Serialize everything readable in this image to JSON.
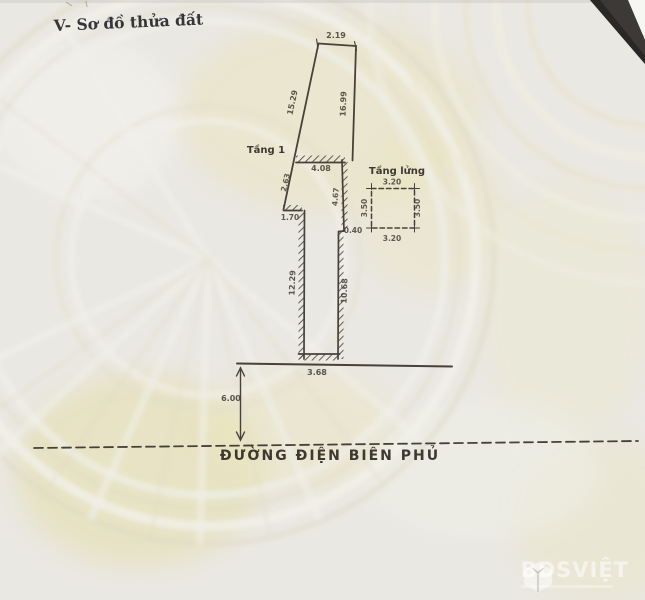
{
  "title": "V- Sơ đồ thửa đất",
  "plot": {
    "floor1_label": "Tầng 1",
    "mezzanine_label": "Tầng lửng",
    "street_name": "ĐƯỜNG ĐIỆN BIÊN PHỦ",
    "dims": {
      "top_width": "2.19",
      "left_side": "15.29",
      "right_side": "16.99",
      "f1_top": "4.08",
      "f1_left_slant": "2.63",
      "f1_notch": "1.70",
      "f1_right_upper": "4.67",
      "f1_step": "0.40",
      "f1_left": "12.29",
      "f1_right_lower": "10.68",
      "f1_bottom": "3.68",
      "mezz_top": "3.20",
      "mezz_bottom": "3.20",
      "mezz_left": "3.50",
      "mezz_right": "3.50",
      "road_setback": "6.00"
    }
  },
  "watermark": {
    "brand": "BDSVIỆT"
  },
  "colors": {
    "ink": "#47413a",
    "paper": "#eae8e2",
    "seal_yellow": "#e8e2ba",
    "corner_dark": "#34322f"
  }
}
